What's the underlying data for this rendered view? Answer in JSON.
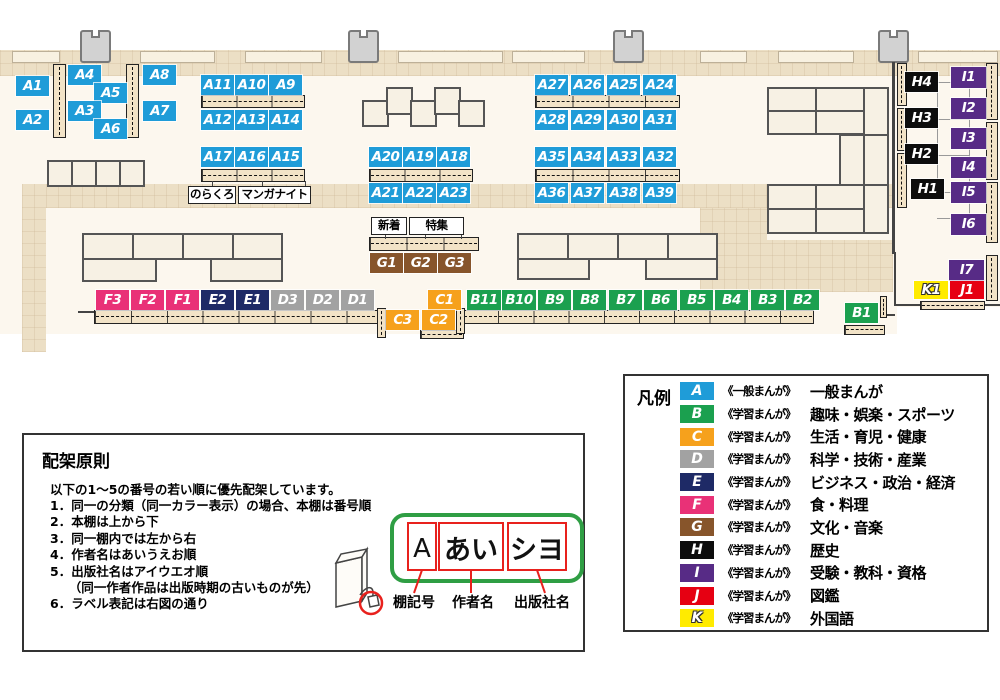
{
  "colors": {
    "A": "#1f9cd8",
    "B": "#1ba04f",
    "C": "#f6a11c",
    "D": "#a2a2a2",
    "E": "#1e2a66",
    "F": "#e93177",
    "G": "#87552b",
    "H": "#0d0d0d",
    "I": "#572b86",
    "J": "#e60012",
    "K": "#ffeb00"
  },
  "map": {
    "shelf_labels": [
      {
        "id": "A1",
        "x": 16,
        "y": 76
      },
      {
        "id": "A2",
        "x": 16,
        "y": 110
      },
      {
        "id": "A4",
        "x": 68,
        "y": 65
      },
      {
        "id": "A5",
        "x": 94,
        "y": 83
      },
      {
        "id": "A3",
        "x": 68,
        "y": 101
      },
      {
        "id": "A6",
        "x": 94,
        "y": 119
      },
      {
        "id": "A8",
        "x": 143,
        "y": 65
      },
      {
        "id": "A7",
        "x": 143,
        "y": 101
      },
      {
        "id": "A11",
        "x": 201,
        "y": 75
      },
      {
        "id": "A10",
        "x": 235,
        "y": 75
      },
      {
        "id": "A9",
        "x": 269,
        "y": 75
      },
      {
        "id": "A12",
        "x": 201,
        "y": 110
      },
      {
        "id": "A13",
        "x": 235,
        "y": 110
      },
      {
        "id": "A14",
        "x": 269,
        "y": 110
      },
      {
        "id": "A17",
        "x": 201,
        "y": 147
      },
      {
        "id": "A16",
        "x": 235,
        "y": 147
      },
      {
        "id": "A15",
        "x": 269,
        "y": 147
      },
      {
        "id": "A20",
        "x": 369,
        "y": 147
      },
      {
        "id": "A19",
        "x": 403,
        "y": 147
      },
      {
        "id": "A18",
        "x": 437,
        "y": 147
      },
      {
        "id": "A21",
        "x": 369,
        "y": 183
      },
      {
        "id": "A22",
        "x": 403,
        "y": 183
      },
      {
        "id": "A23",
        "x": 437,
        "y": 183
      },
      {
        "id": "A27",
        "x": 535,
        "y": 75
      },
      {
        "id": "A26",
        "x": 571,
        "y": 75
      },
      {
        "id": "A25",
        "x": 607,
        "y": 75
      },
      {
        "id": "A24",
        "x": 643,
        "y": 75
      },
      {
        "id": "A28",
        "x": 535,
        "y": 110
      },
      {
        "id": "A29",
        "x": 571,
        "y": 110
      },
      {
        "id": "A30",
        "x": 607,
        "y": 110
      },
      {
        "id": "A31",
        "x": 643,
        "y": 110
      },
      {
        "id": "A35",
        "x": 535,
        "y": 147
      },
      {
        "id": "A34",
        "x": 571,
        "y": 147
      },
      {
        "id": "A33",
        "x": 607,
        "y": 147
      },
      {
        "id": "A32",
        "x": 643,
        "y": 147
      },
      {
        "id": "A36",
        "x": 535,
        "y": 183
      },
      {
        "id": "A37",
        "x": 571,
        "y": 183
      },
      {
        "id": "A38",
        "x": 607,
        "y": 183
      },
      {
        "id": "A39",
        "x": 643,
        "y": 183
      },
      {
        "id": "G1",
        "x": 370,
        "y": 253
      },
      {
        "id": "G2",
        "x": 404,
        "y": 253
      },
      {
        "id": "G3",
        "x": 438,
        "y": 253
      },
      {
        "id": "F3",
        "x": 96,
        "y": 290
      },
      {
        "id": "F2",
        "x": 131,
        "y": 290
      },
      {
        "id": "F1",
        "x": 166,
        "y": 290
      },
      {
        "id": "E2",
        "x": 201,
        "y": 290
      },
      {
        "id": "E1",
        "x": 236,
        "y": 290
      },
      {
        "id": "D3",
        "x": 271,
        "y": 290
      },
      {
        "id": "D2",
        "x": 306,
        "y": 290
      },
      {
        "id": "D1",
        "x": 341,
        "y": 290
      },
      {
        "id": "C1",
        "x": 428,
        "y": 290
      },
      {
        "id": "B11",
        "x": 467,
        "y": 290,
        "w": 34
      },
      {
        "id": "B10",
        "x": 502,
        "y": 290,
        "w": 34
      },
      {
        "id": "B9",
        "x": 538,
        "y": 290
      },
      {
        "id": "B8",
        "x": 573,
        "y": 290
      },
      {
        "id": "B7",
        "x": 609,
        "y": 290
      },
      {
        "id": "B6",
        "x": 644,
        "y": 290
      },
      {
        "id": "B5",
        "x": 680,
        "y": 290
      },
      {
        "id": "B4",
        "x": 715,
        "y": 290
      },
      {
        "id": "B3",
        "x": 751,
        "y": 290
      },
      {
        "id": "B2",
        "x": 786,
        "y": 290
      },
      {
        "id": "C3",
        "x": 386,
        "y": 310
      },
      {
        "id": "C2",
        "x": 422,
        "y": 310
      },
      {
        "id": "B1",
        "x": 845,
        "y": 303
      },
      {
        "id": "H4",
        "x": 905,
        "y": 72
      },
      {
        "id": "H3",
        "x": 905,
        "y": 108
      },
      {
        "id": "H2",
        "x": 905,
        "y": 144
      },
      {
        "id": "H1",
        "x": 911,
        "y": 179
      },
      {
        "id": "I1",
        "x": 951,
        "y": 67,
        "w": 35,
        "h": 21
      },
      {
        "id": "I2",
        "x": 951,
        "y": 98,
        "w": 35,
        "h": 21
      },
      {
        "id": "I3",
        "x": 951,
        "y": 128,
        "w": 35,
        "h": 21
      },
      {
        "id": "I4",
        "x": 951,
        "y": 157,
        "w": 35,
        "h": 21
      },
      {
        "id": "I5",
        "x": 951,
        "y": 182,
        "w": 35,
        "h": 21
      },
      {
        "id": "I6",
        "x": 951,
        "y": 214,
        "w": 35,
        "h": 21
      },
      {
        "id": "I7",
        "x": 949,
        "y": 260,
        "w": 35,
        "h": 21
      },
      {
        "id": "K1",
        "x": 914,
        "y": 281,
        "w": 34,
        "h": 18
      },
      {
        "id": "J1",
        "x": 950,
        "y": 281,
        "w": 34,
        "h": 18
      }
    ],
    "annotations": [
      {
        "id": "norakuro",
        "text": "のらくろ",
        "x": 188,
        "y": 186,
        "w": 48
      },
      {
        "id": "manga-night",
        "text": "マンガナイト",
        "x": 238,
        "y": 186,
        "w": 73
      },
      {
        "id": "shinchaku",
        "text": "新着",
        "x": 371,
        "y": 217,
        "w": 36
      },
      {
        "id": "tokushu",
        "text": "特集",
        "x": 409,
        "y": 217,
        "w": 55
      }
    ]
  },
  "legend": {
    "title": "凡例",
    "items": [
      {
        "letter": "A",
        "prefix": "《一般まんが》",
        "category": "一般まんが"
      },
      {
        "letter": "B",
        "prefix": "《学習まんが》",
        "category": "趣味・娯楽・スポーツ"
      },
      {
        "letter": "C",
        "prefix": "《学習まんが》",
        "category": "生活・育児・健康"
      },
      {
        "letter": "D",
        "prefix": "《学習まんが》",
        "category": "科学・技術・産業"
      },
      {
        "letter": "E",
        "prefix": "《学習まんが》",
        "category": "ビジネス・政治・経済"
      },
      {
        "letter": "F",
        "prefix": "《学習まんが》",
        "category": "食・料理"
      },
      {
        "letter": "G",
        "prefix": "《学習まんが》",
        "category": "文化・音楽"
      },
      {
        "letter": "H",
        "prefix": "《学習まんが》",
        "category": "歴史"
      },
      {
        "letter": "I",
        "prefix": "《学習まんが》",
        "category": "受験・教科・資格"
      },
      {
        "letter": "J",
        "prefix": "《学習まんが》",
        "category": "図鑑"
      },
      {
        "letter": "K",
        "prefix": "《学習まんが》",
        "category": "外国語"
      }
    ]
  },
  "principles": {
    "title": "配架原則",
    "intro": "以下の1～5の番号の若い順に優先配架しています。",
    "items": [
      "1．同一の分類（同一カラー表示）の場合、本棚は番号順",
      "2．本棚は上から下",
      "3．同一棚内では左から右",
      "4．作者名はあいうえお順",
      "5．出版社名はアイウエオ順",
      "　　（同一作者作品は出版時期の古いものが先）",
      "6．ラベル表記は右図の通り"
    ]
  },
  "label_diagram": {
    "boxes": [
      "A",
      "あい",
      "シヨ"
    ],
    "captions": [
      "棚記号",
      "作者名",
      "出版社名"
    ]
  }
}
